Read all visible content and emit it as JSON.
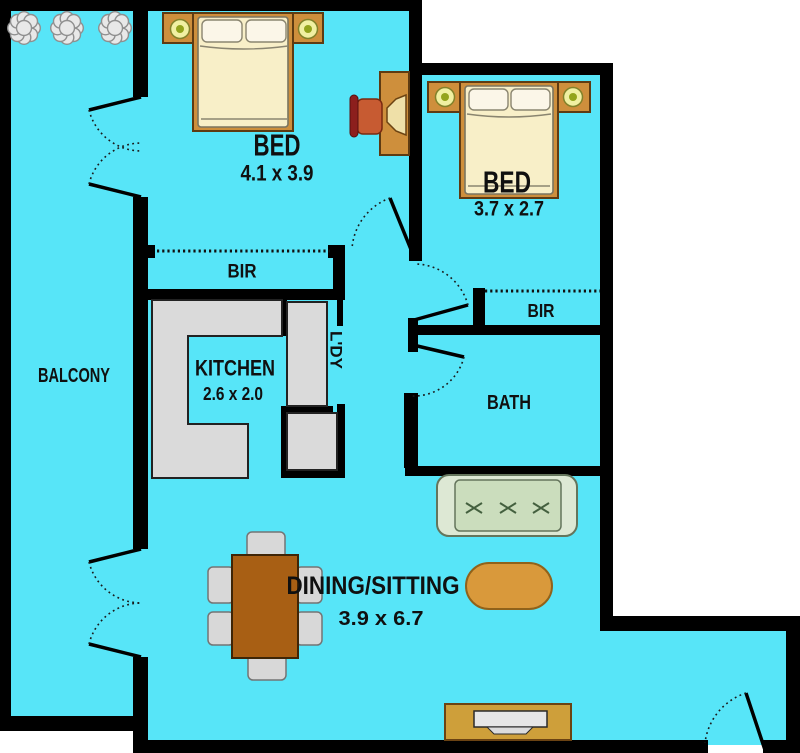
{
  "plan": {
    "rooms": {
      "balcony": {
        "label": "BALCONY"
      },
      "bed1": {
        "label": "BED",
        "dims": "4.1 x 3.9"
      },
      "bed2": {
        "label": "BED",
        "dims": "3.7 x 2.7"
      },
      "bir1": {
        "label": "BIR"
      },
      "bir2": {
        "label": "BIR"
      },
      "kitchen": {
        "label": "KITCHEN",
        "dims": "2.6 x 2.0"
      },
      "laundry": {
        "label": "L'DY"
      },
      "bath": {
        "label": "BATH"
      },
      "dining": {
        "label": "DINING/SITTING",
        "dims": "3.9 x 6.7"
      }
    },
    "colors": {
      "floor": "#57E5F8",
      "wall": "#000000",
      "outside": "#FFFFFF",
      "timber": "#CE8F3C",
      "counter": "#DADADA",
      "mattress": "#F8EFC8",
      "pillow": "#FBF6E8",
      "lamp_ring": "#F0F0A2",
      "lamp_dot": "#93A41C",
      "desk_chair_seat": "#C75B32",
      "desk_chair_back": "#8C1F1D",
      "sofa_frame": "#DDE8D4",
      "sofa_cushion": "#CBDDBD",
      "ottoman": "#D9993B",
      "dining_table": "#A85F14",
      "dining_chair": "#D8D8D8",
      "tv_screen": "#E6E6E6",
      "plant": "#E8E8E8",
      "label_text": "#101010"
    },
    "furniture_icons": [
      "double-bed",
      "bedside-table-with-lamp",
      "desk-with-chair",
      "built-in-robe-dashed-front",
      "kitchen-counter",
      "washing-machine",
      "storage-cupboard",
      "sofa",
      "ottoman",
      "dining-table-with-six-chairs",
      "tv-unit",
      "balcony-plants",
      "door-swing"
    ]
  }
}
